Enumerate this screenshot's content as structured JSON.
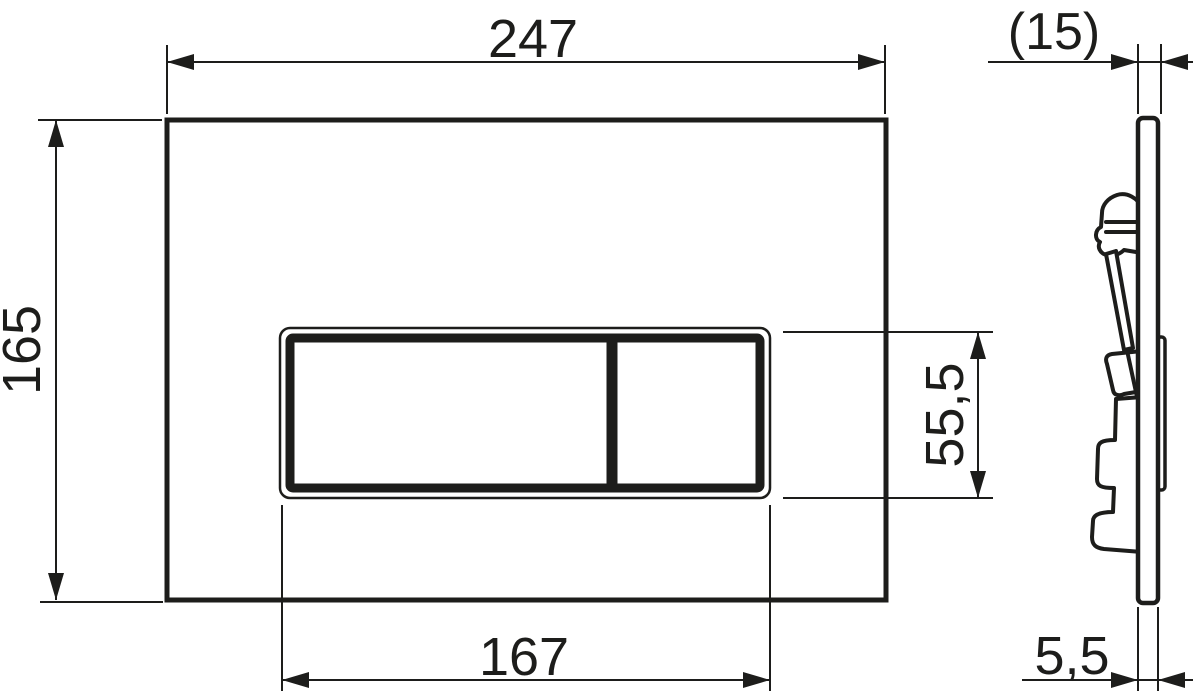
{
  "drawing": {
    "background_color": "#ffffff",
    "line_color": "#1d1d1b",
    "dimensions": {
      "plate_width": "247",
      "plate_height": "165",
      "button_cutout_width": "167",
      "button_cutout_height": "55,5",
      "total_depth": "(15)",
      "plate_thickness": "5,5"
    }
  }
}
